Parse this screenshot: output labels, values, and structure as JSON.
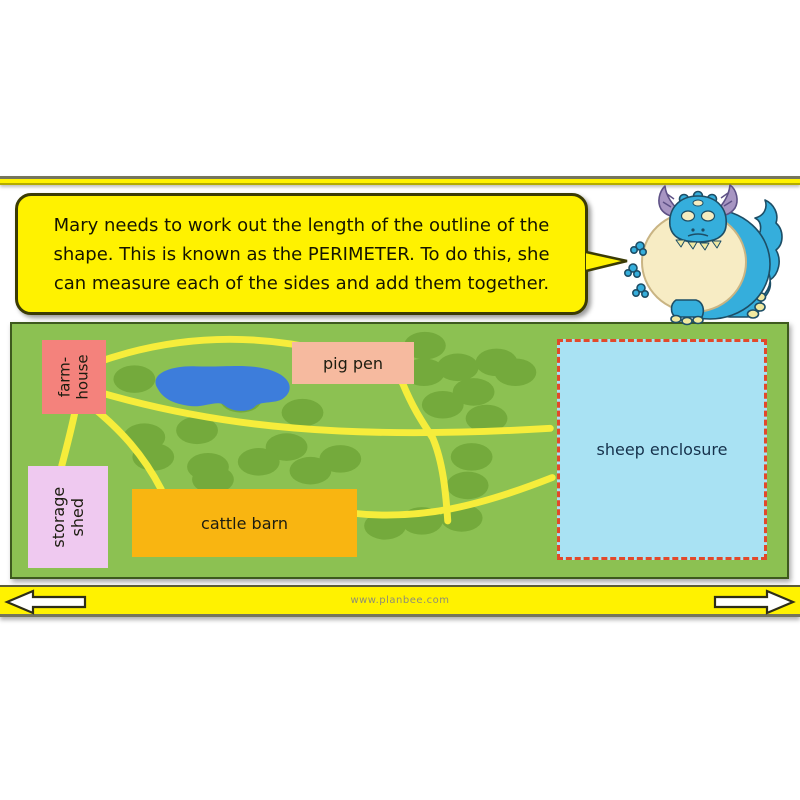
{
  "speech": {
    "lines": [
      "Mary needs to work out the length of the outline of the",
      "shape. This is known as the PERIMETER. To do this, she",
      "can measure each of the sides and add them together."
    ]
  },
  "map": {
    "farmhouse": {
      "lines": [
        "farm-",
        "house"
      ]
    },
    "storage_shed": {
      "lines": [
        "storage",
        "shed"
      ]
    },
    "pig_pen": {
      "label": "pig pen"
    },
    "cattle_barn": {
      "label": "cattle barn"
    },
    "sheep_enclosure": {
      "label": "sheep enclosure"
    },
    "bushes": [
      [
        123,
        56
      ],
      [
        133,
        115
      ],
      [
        186,
        108
      ],
      [
        142,
        135
      ],
      [
        202,
        158
      ],
      [
        230,
        76
      ],
      [
        292,
        90
      ],
      [
        276,
        125
      ],
      [
        197,
        145
      ],
      [
        248,
        140
      ],
      [
        300,
        149
      ],
      [
        330,
        137
      ],
      [
        415,
        22
      ],
      [
        414,
        49
      ],
      [
        448,
        44
      ],
      [
        487,
        39
      ],
      [
        464,
        69
      ],
      [
        433,
        82
      ],
      [
        477,
        96
      ],
      [
        506,
        49
      ],
      [
        462,
        135
      ],
      [
        458,
        164
      ],
      [
        375,
        205
      ],
      [
        412,
        200
      ],
      [
        452,
        197
      ]
    ],
    "paths": [
      "M 83,40 C 170,8 250,11 320,28 C 370,40 388,50 393,61 C 405,90 415,103 423,116 C 433,140 436,170 438,200",
      "M 83,68 C 210,106 340,118 541,106",
      "M 340,192 C 410,200 470,185 543,156",
      "M 64,86 C 60,105 55,125 50,144",
      "M 78,82 C 110,108 132,133 150,168"
    ],
    "pond": "M 145,63 C 140,50 160,42 185,43 C 215,44 235,40 257,46 C 282,53 284,68 272,76 C 264,81 252,78 245,83 C 240,90 222,90 214,83 C 207,76 192,86 177,83 C 157,80 150,73 145,63 Z"
  },
  "footer": {
    "website": "www.planbee.com"
  },
  "colors": {
    "slide_yellow": "#FFF200",
    "box_border": "#3B3B05",
    "map_green": "#8CC152",
    "map_border": "#3E5A1E",
    "bush_green": "#74AA3C",
    "path_yellow": "#F6ED3B",
    "pond_blue": "#3D7DDB",
    "farmhouse_pink": "#F4827C",
    "shed_lilac": "#EFC9F0",
    "pigpen_peach": "#F6BA9F",
    "barn_orange": "#F9B511",
    "enclosure_blue": "#A9E2F3",
    "enclosure_border": "#E2492B",
    "footer_text": "#8D8D75",
    "dragon_blue": "#35AEDC",
    "dragon_belly": "#F7ECC4",
    "dragon_horn": "#A795C2"
  }
}
